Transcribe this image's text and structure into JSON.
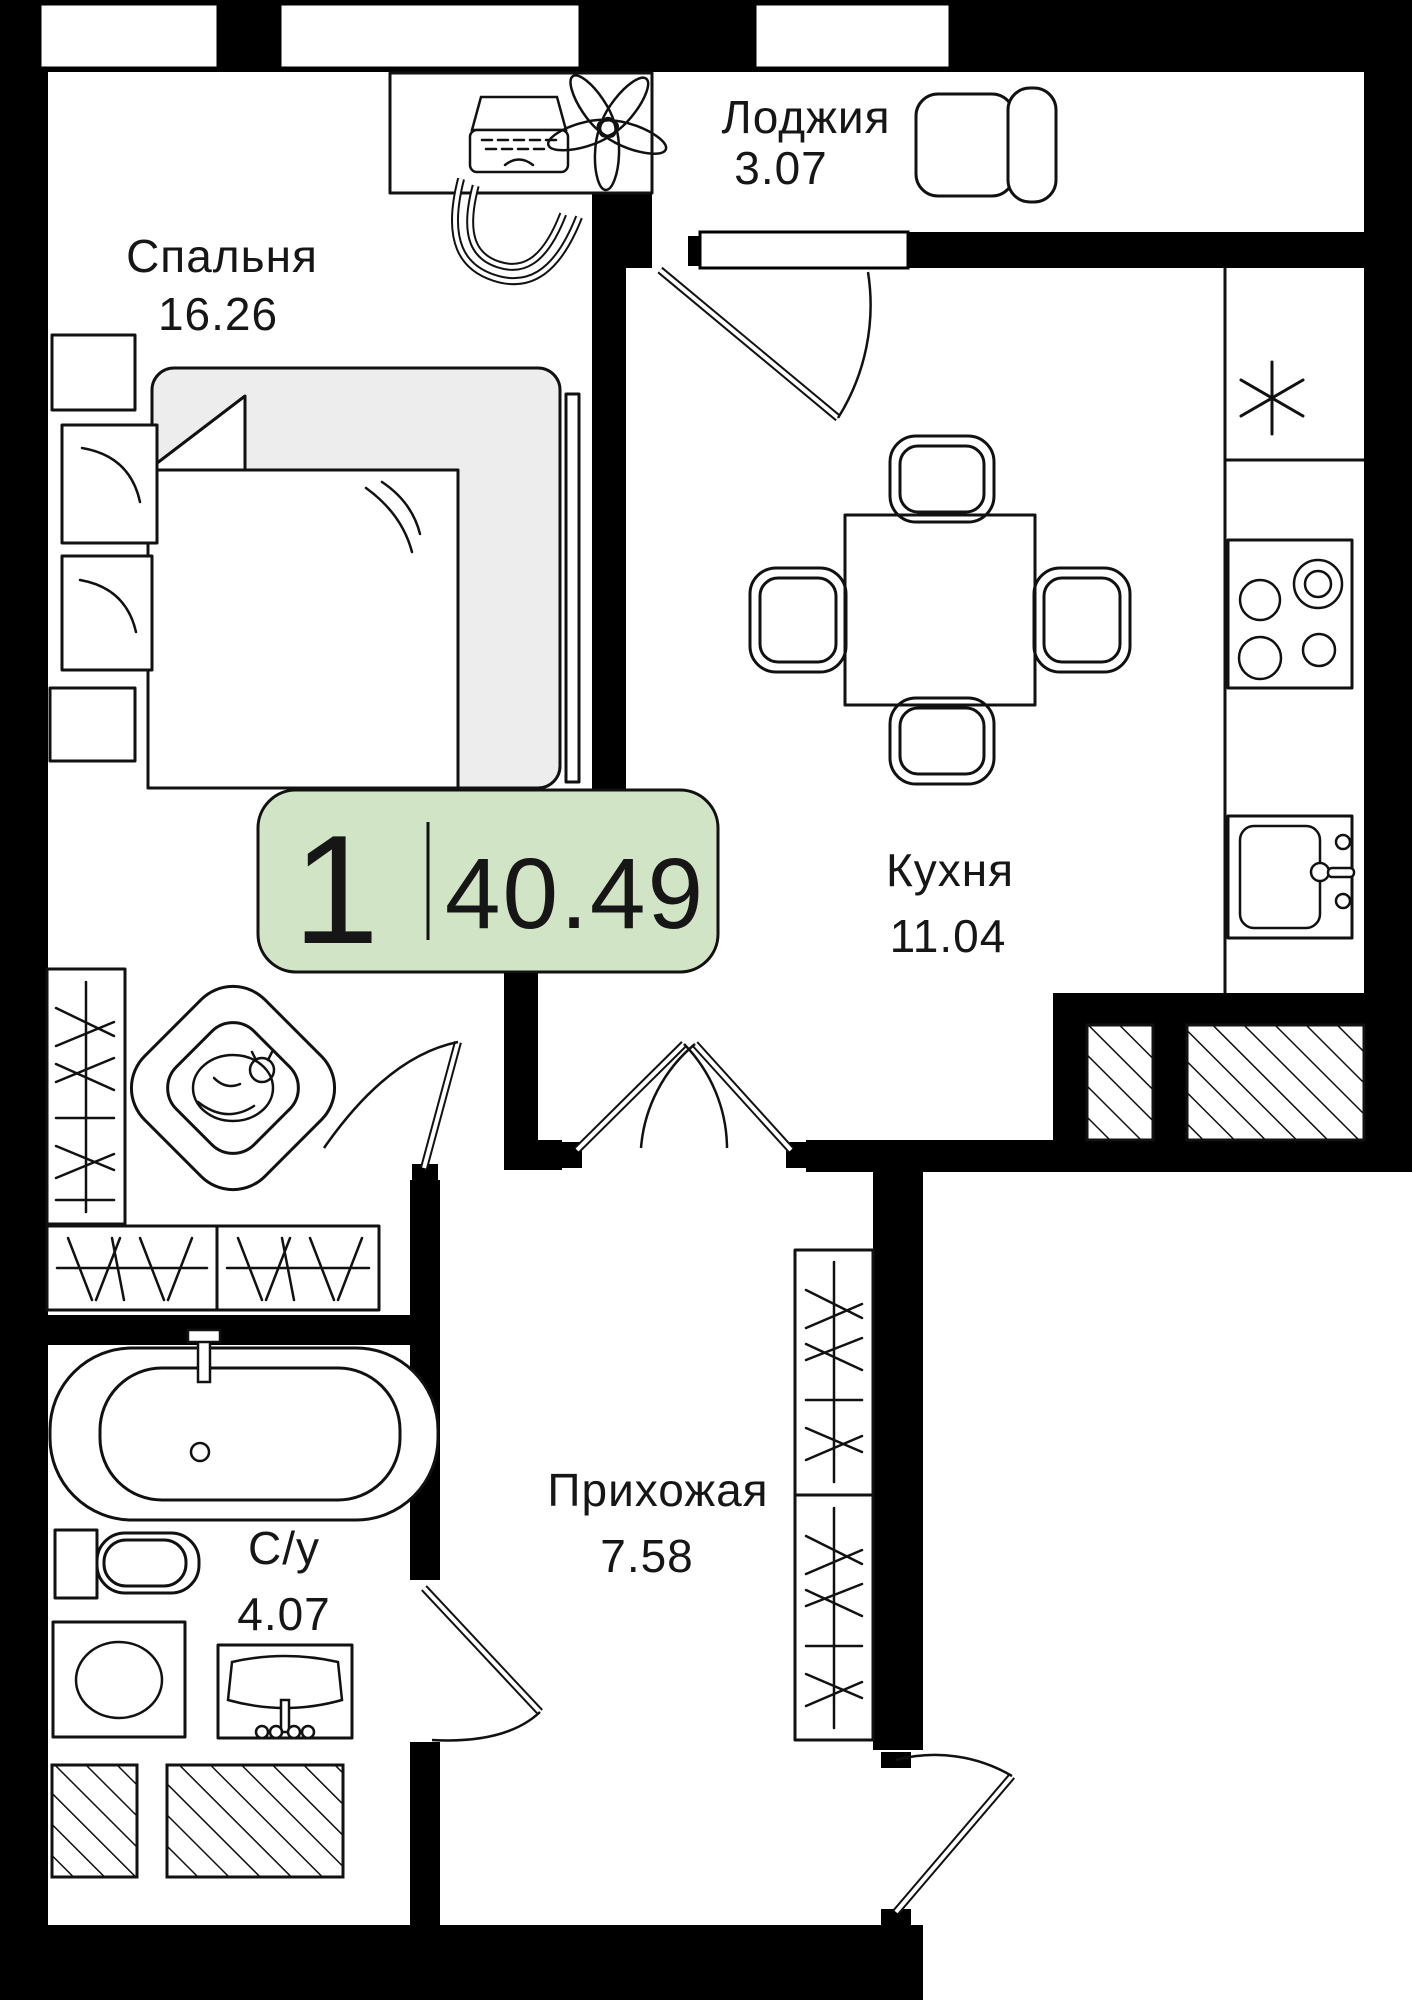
{
  "title": "apartment-floor-plan",
  "badge": {
    "room_count": "1",
    "total_area": "40.49",
    "bg_color": "#d2e4c6",
    "border_color": "#111111"
  },
  "rooms": [
    {
      "key": "bedroom",
      "label": "Спальня",
      "area": "16.26"
    },
    {
      "key": "loggia",
      "label": "Лоджия",
      "area": "3.07"
    },
    {
      "key": "kitchen",
      "label": "Кухня",
      "area": "11.04"
    },
    {
      "key": "hallway",
      "label": "Прихожая",
      "area": "7.58"
    },
    {
      "key": "bathroom",
      "label": "С/у",
      "area": "4.07"
    }
  ],
  "icons": [
    {
      "name": "desk-laptop-icon"
    },
    {
      "name": "office-chair-icon"
    },
    {
      "name": "flower-icon"
    },
    {
      "name": "loggia-armchair-icon"
    },
    {
      "name": "dining-table-icon"
    },
    {
      "name": "dining-chair-icon"
    },
    {
      "name": "fridge-asterisk-icon"
    },
    {
      "name": "stove-burners-icon"
    },
    {
      "name": "kitchen-sink-icon"
    },
    {
      "name": "bed-icon"
    },
    {
      "name": "nightstand-icon"
    },
    {
      "name": "armchair-with-cat-icon"
    },
    {
      "name": "wardrobe-hangers-icon"
    },
    {
      "name": "bathtub-icon"
    },
    {
      "name": "toilet-icon"
    },
    {
      "name": "washing-machine-icon"
    },
    {
      "name": "washbasin-icon"
    },
    {
      "name": "door-swing-icon"
    },
    {
      "name": "ventilation-shaft-hatch"
    },
    {
      "name": "window-icon"
    }
  ],
  "colors": {
    "walls": "#000000",
    "lines": "#111111",
    "bed_fill": "#ededed",
    "badge_green": "#d2e4c6",
    "background": "#ffffff"
  }
}
